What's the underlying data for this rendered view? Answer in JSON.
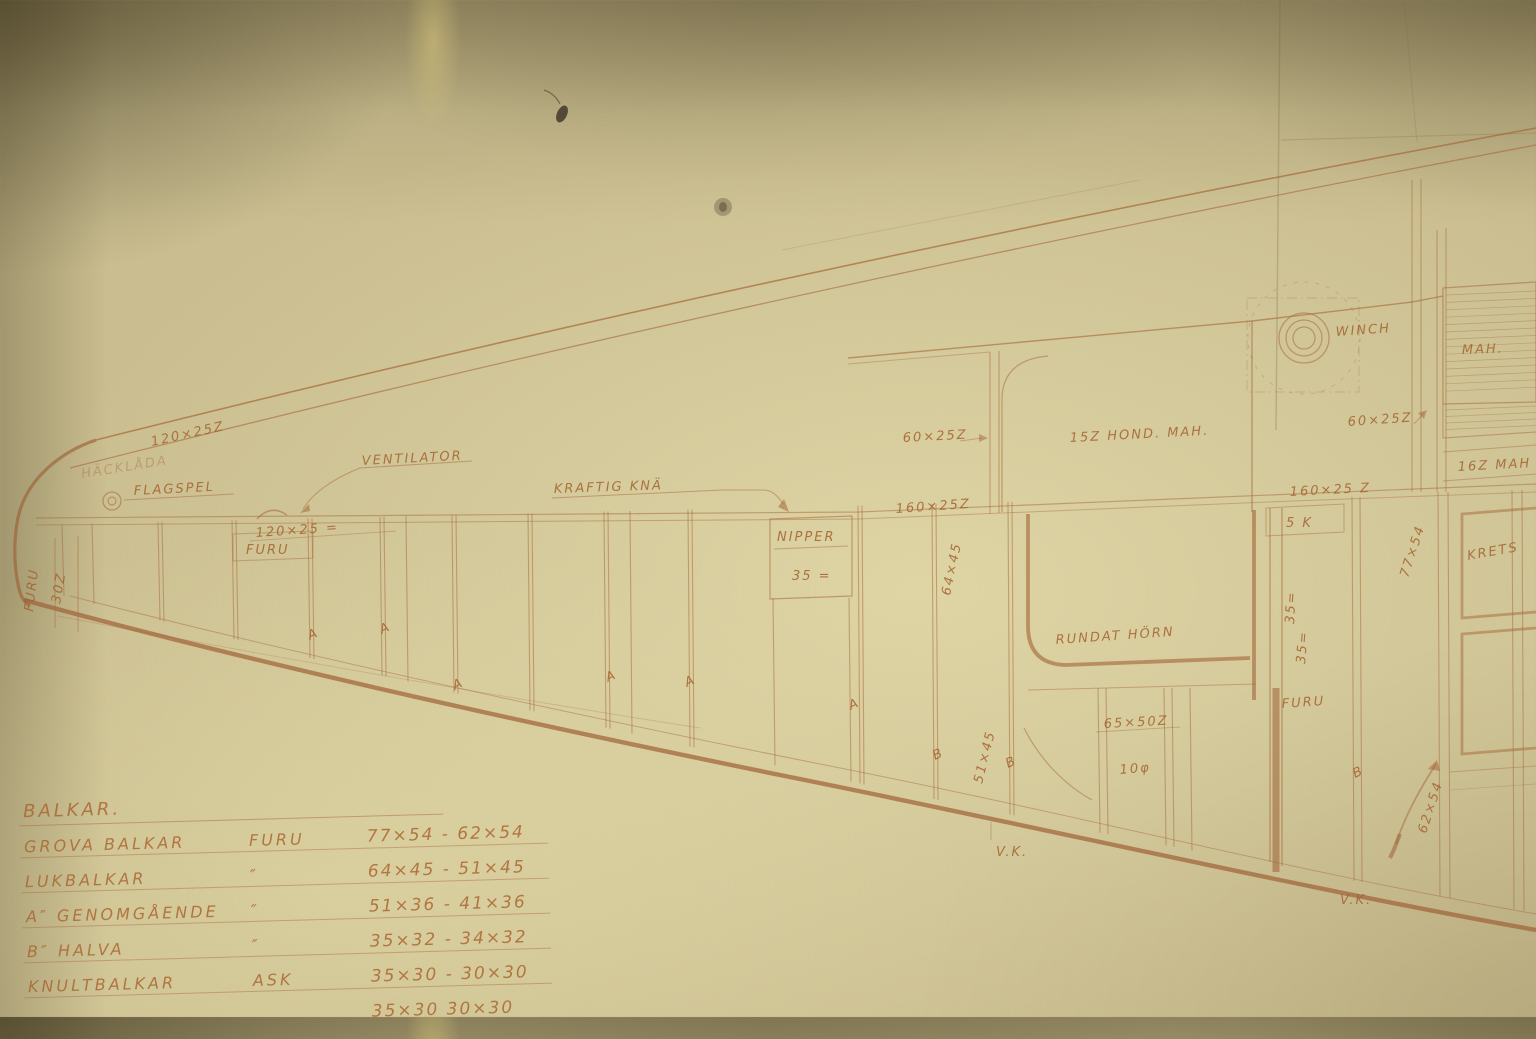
{
  "colors": {
    "paper": "#cabe90",
    "ink": "#a5683a",
    "ink_strong": "#9e6136"
  },
  "labels": {
    "deck_dim_upper": "120×25Z",
    "stern_note": "HÄCKLÅDA",
    "flagspel": "FLAGSPEL",
    "deck_dim_lower": "120×25 =",
    "furu_box": "FURU",
    "furu_tip": "FURU",
    "tip_dim": "30Z",
    "ventilator": "VENTILATOR",
    "kraftig_kna": "KRAFTIG KNÄ",
    "nipper": "NIPPER",
    "nipper_dim": "35 =",
    "dim_60x25_left": "60×25Z",
    "panel_mah_15": "15Z HOND. MAH.",
    "dim_160x25_left": "160×25Z",
    "dim_64x45": "64×45",
    "winch": "WINCH",
    "dim_60x25_right": "60×25Z",
    "dim_160x25_right": "160×25 Z",
    "mah": "MAH.",
    "dim_16_mah": "16Z MAH",
    "krets": "KRETS",
    "dim_77x54": "77×54",
    "rundat_horn": "RUNDAT HÖRN",
    "dim_5k": "5 K",
    "dim_35_upper": "35=",
    "dim_35_lower": "35=",
    "dim_65x50": "65×50Z",
    "dim_10": "10φ",
    "furu_right": "FURU",
    "dim_51x45": "51×45",
    "dim_62x54": "62×54",
    "vk_left": "V.K.",
    "vk_right": "V.K."
  },
  "frame_letters": [
    "A",
    "A",
    "A",
    "A",
    "A",
    "A",
    "B",
    "B",
    "B"
  ],
  "table": {
    "title": "BALKAR.",
    "rows": [
      {
        "name": "GROVA BALKAR",
        "material": "FURU",
        "dims": "77×54 - 62×54"
      },
      {
        "name": "LUKBALKAR",
        "material": "″",
        "dims": "64×45 - 51×45"
      },
      {
        "name": "A″ GENOMGÅENDE",
        "material": "″",
        "dims": "51×36 - 41×36"
      },
      {
        "name": "B″ HALVA",
        "material": "″",
        "dims": "35×32 - 34×32"
      },
      {
        "name": "KNULTBALKAR",
        "material": "ASK",
        "dims": "35×30 - 30×30"
      },
      {
        "name": "",
        "material": "",
        "dims": "35×30   30×30"
      }
    ]
  }
}
